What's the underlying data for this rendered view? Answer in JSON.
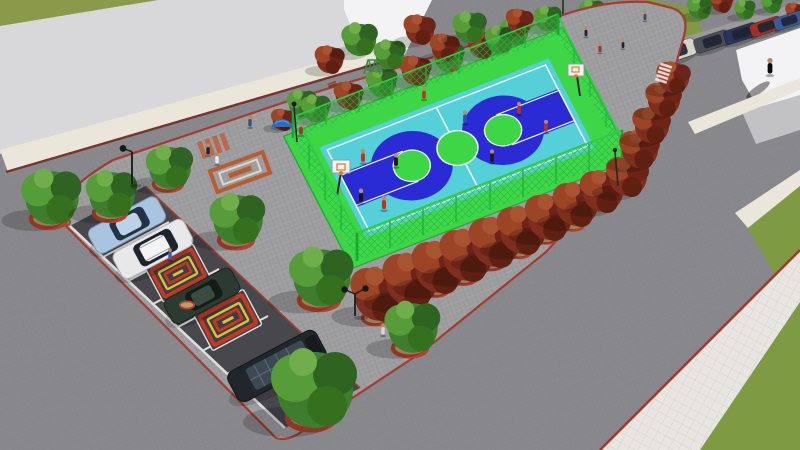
{
  "scene": {
    "type": "3d-architectural-rendering",
    "view": "aerial-isometric-perspective",
    "subject": "Park plan: fenced basketball court, angled parking with patterned stalls, tree-lined walkways, surrounding streets and lawns"
  },
  "colors": {
    "road": "#88888c",
    "parking_asphalt": "#47474c",
    "block_pavers": "#9d9da0",
    "sidewalk": "#eae6da",
    "curb_red": "#a33b30",
    "building_roof": "#d8d8da",
    "building_wall": "#f3f3f5",
    "grass": "#7e9b43",
    "park_path_red": "#a5503c",
    "court_apron_green": "#3ed647",
    "court_surface_cyan": "#55cfd8",
    "court_key_blue": "#2b2bd5",
    "court_circle_green": "#3ed647",
    "court_line_white": "#eef9f9",
    "fence_green": "#22b53a",
    "tree_green": "#3f7d2e",
    "tree_red_autumn": "#7e2e1e",
    "planter_tan": "#c09a66",
    "planter_ring_red": "#ae4234",
    "stall_mat_red": "#c23824",
    "stall_mat_yellow": "#d8c23a"
  },
  "inventory": {
    "basketball_courts": 1,
    "basketball_hoops": 2,
    "court_players": 9,
    "parking_stall_vehicles": 5,
    "street_parked_vehicles": 7,
    "decorative_stall_mats": 3,
    "green_trees": 18,
    "red_trees": 22,
    "tree_planters": 16,
    "street_lamps": 4,
    "pedestrians": 10,
    "buildings": 2,
    "lawns": 3,
    "crosswalks": 2
  }
}
